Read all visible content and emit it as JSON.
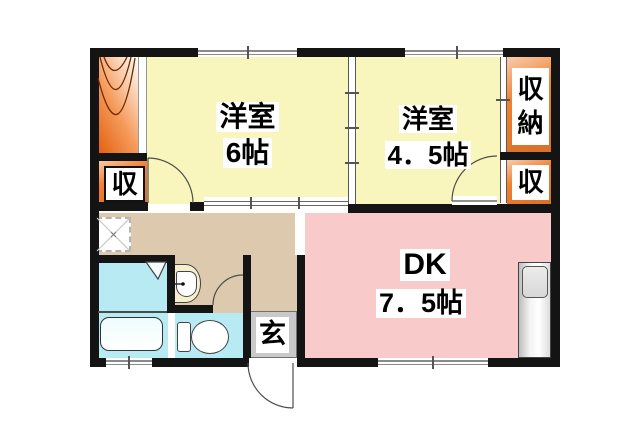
{
  "floorplan": {
    "rooms": {
      "west6": {
        "name": "洋室",
        "size": "6帖"
      },
      "west45": {
        "name": "洋室",
        "size": "4．5帖"
      },
      "dk": {
        "name": "DK",
        "size": "7．5帖"
      }
    },
    "storage": {
      "closet_right_top": "収納",
      "closet_right_mid": "収",
      "closet_left": "収"
    },
    "entrance_label": "玄",
    "colors": {
      "wall": "#141414",
      "room_yellow": "#f8f6bc",
      "dk_pink": "#f9caca",
      "closet_orange": "#ef8132",
      "hallway_beige": "#dcc9ae",
      "wet_area_cyan": "#b7eaf2",
      "entrance_gray": "#c9c9c9",
      "stairs_deep_orange": "#e2600f"
    }
  }
}
